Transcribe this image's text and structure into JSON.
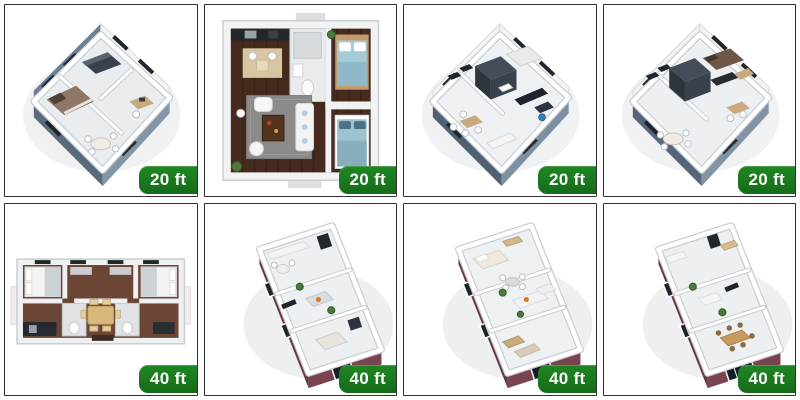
{
  "grid": {
    "rows": 2,
    "columns": 4,
    "border_color": "#313131",
    "background": "#ffffff"
  },
  "badge": {
    "background": "#1b7c1f",
    "text_color": "#ffffff"
  },
  "colors": {
    "exterior_blue_gray": "#64788c",
    "exterior_maroon": "#6f3c48",
    "dark_wood_floor": "#452a1e",
    "brown_floor": "#6b4634",
    "light_floor": "#edf0f2"
  },
  "tiles": [
    {
      "label": "20 ft",
      "image": "isometric-floor-plan-20ft-blue-gray-bedroom"
    },
    {
      "label": "20 ft",
      "image": "top-down-floor-plan-20ft-dark-wood-two-bedrooms"
    },
    {
      "label": "20 ft",
      "image": "isometric-floor-plan-20ft-white-studio"
    },
    {
      "label": "20 ft",
      "image": "isometric-floor-plan-20ft-white-bedroom"
    },
    {
      "label": "40 ft",
      "image": "top-down-floor-plan-40ft-brown-two-bedrooms"
    },
    {
      "label": "40 ft",
      "image": "isometric-floor-plan-40ft-maroon-a"
    },
    {
      "label": "40 ft",
      "image": "isometric-floor-plan-40ft-maroon-b"
    },
    {
      "label": "40 ft",
      "image": "isometric-floor-plan-40ft-maroon-c"
    }
  ]
}
